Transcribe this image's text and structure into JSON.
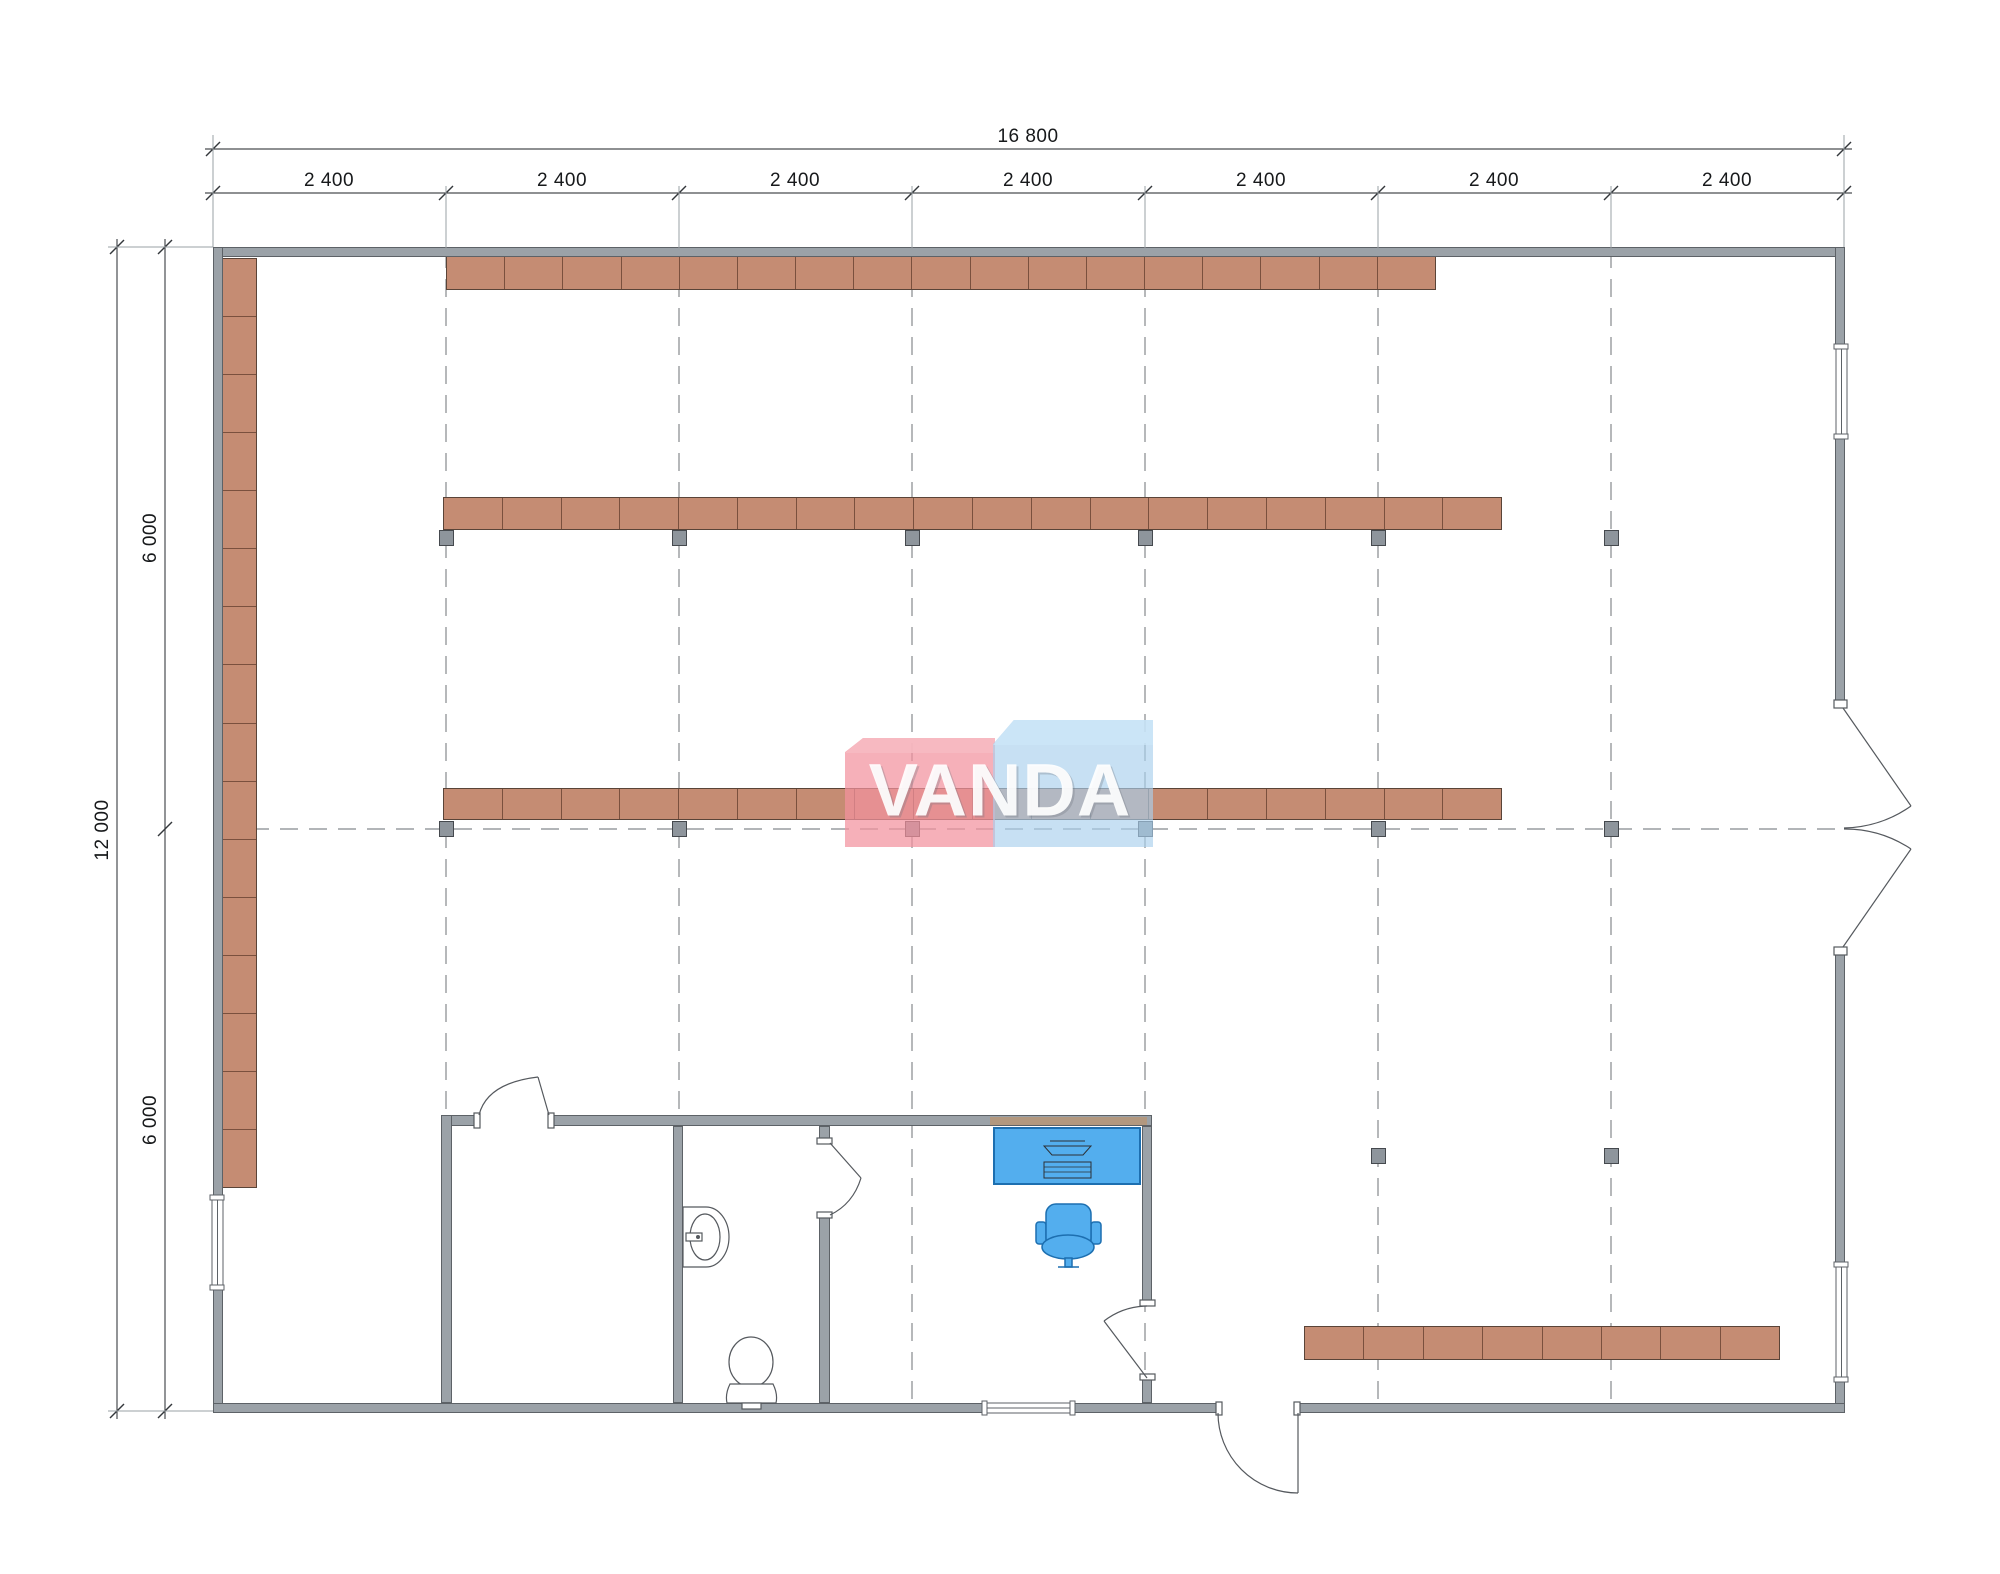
{
  "title": "Retail floor plan 16800 x 12000",
  "watermark": {
    "text": "VANDA"
  },
  "dimensions": {
    "top_total": "16 800",
    "top_bays": [
      "2 400",
      "2 400",
      "2 400",
      "2 400",
      "2 400",
      "2 400",
      "2 400"
    ],
    "left_total": "12 000",
    "left_halves": [
      "6 000",
      "6 000"
    ]
  },
  "colors": {
    "wall": "#9ba2a8",
    "wall_border": "#5d6267",
    "shelf": "#c58c73",
    "shelf_border": "#7a503e",
    "column": "#8e959c",
    "column_border": "#45494e",
    "furniture": "#53aeee",
    "furniture_border": "#1d6fb0",
    "grid_line": "#85898d",
    "dim_line": "#4a4e52",
    "fixture_line": "#55595e",
    "logo_pink": "rgba(242,146,158,0.72)",
    "logo_pink_lid": "rgba(247,187,195,0.80)",
    "logo_blue": "rgba(169,208,236,0.65)",
    "logo_blue_lid": "rgba(205,230,248,0.72)",
    "logo_text": "#ffffff"
  },
  "plan": {
    "shelf_rows": [
      {
        "name": "left-wall-shelf",
        "x": 222,
        "y": 258,
        "w": 35,
        "h": 930,
        "tiles": 16,
        "vertical": true
      },
      {
        "name": "top-shelf-row",
        "x": 446,
        "y": 256,
        "w": 990,
        "h": 34,
        "tiles": 17,
        "vertical": false
      },
      {
        "name": "upper-middle-shelf-row",
        "x": 443,
        "y": 497,
        "w": 1059,
        "h": 33,
        "tiles": 18,
        "vertical": false
      },
      {
        "name": "center-shelf-row",
        "x": 443,
        "y": 788,
        "w": 1059,
        "h": 32,
        "tiles": 18,
        "vertical": false
      },
      {
        "name": "bottom-right-shelf-row",
        "x": 1304,
        "y": 1326,
        "w": 476,
        "h": 34,
        "tiles": 8,
        "vertical": false
      }
    ],
    "columns": [
      {
        "x": 446,
        "y": 530
      },
      {
        "x": 679,
        "y": 530
      },
      {
        "x": 912,
        "y": 530
      },
      {
        "x": 1145,
        "y": 530
      },
      {
        "x": 1378,
        "y": 530
      },
      {
        "x": 1611,
        "y": 530
      },
      {
        "x": 446,
        "y": 821
      },
      {
        "x": 679,
        "y": 821
      },
      {
        "x": 912,
        "y": 821
      },
      {
        "x": 1145,
        "y": 821
      },
      {
        "x": 1378,
        "y": 821
      },
      {
        "x": 1611,
        "y": 821
      },
      {
        "x": 1378,
        "y": 1148
      },
      {
        "x": 1611,
        "y": 1148
      }
    ]
  }
}
